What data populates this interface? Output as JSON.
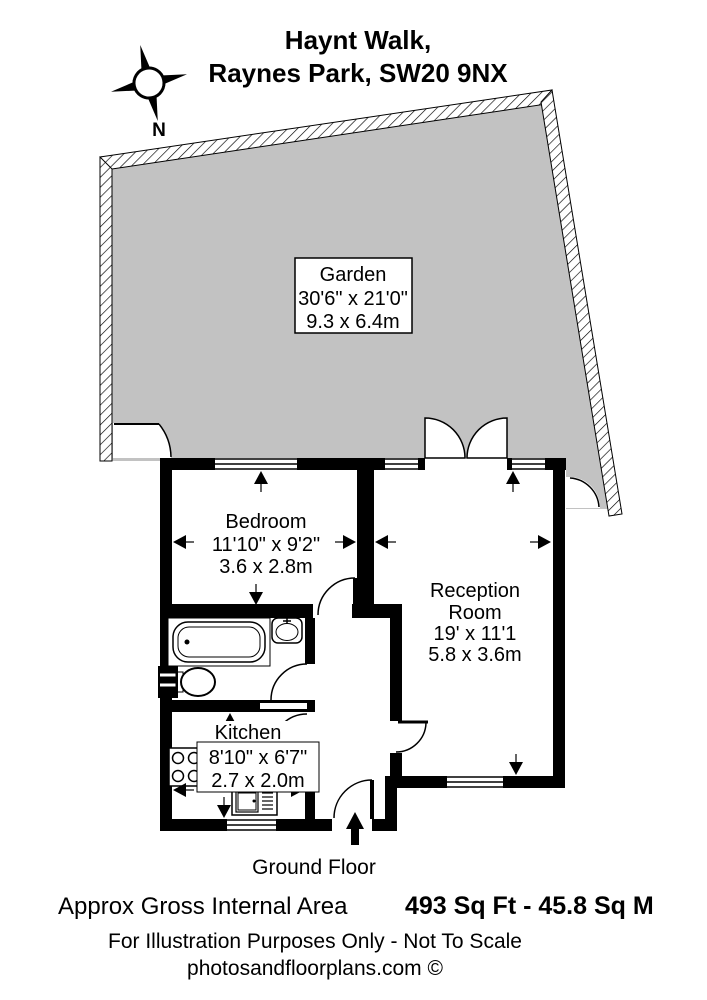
{
  "title": {
    "line1": "Haynt Walk,",
    "line2": "Raynes Park, SW20 9NX"
  },
  "compass": {
    "north_label": "N"
  },
  "garden": {
    "name": "Garden",
    "dims_imperial": "30'6\" x 21'0\"",
    "dims_metric": "9.3 x 6.4m"
  },
  "bedroom": {
    "name": "Bedroom",
    "dims_imperial": "11'10\" x 9'2\"",
    "dims_metric": "3.6 x 2.8m"
  },
  "reception": {
    "name_line1": "Reception",
    "name_line2": "Room",
    "dims_imperial": "19' x 11'1",
    "dims_metric": "5.8 x 3.6m"
  },
  "kitchen": {
    "name": "Kitchen",
    "dims_imperial": "8'10\" x 6'7\"",
    "dims_metric": "2.7 x 2.0m"
  },
  "floor_label": "Ground Floor",
  "footer": {
    "area_label": "Approx Gross Internal Area",
    "area_value": "493 Sq Ft - 45.8 Sq M",
    "disclaimer": "For Illustration Purposes Only - Not To Scale",
    "credit": "photosandfloorplans.com ©"
  },
  "colors": {
    "garden": "#c2c2c2",
    "wall": "#000000",
    "background": "#ffffff"
  }
}
